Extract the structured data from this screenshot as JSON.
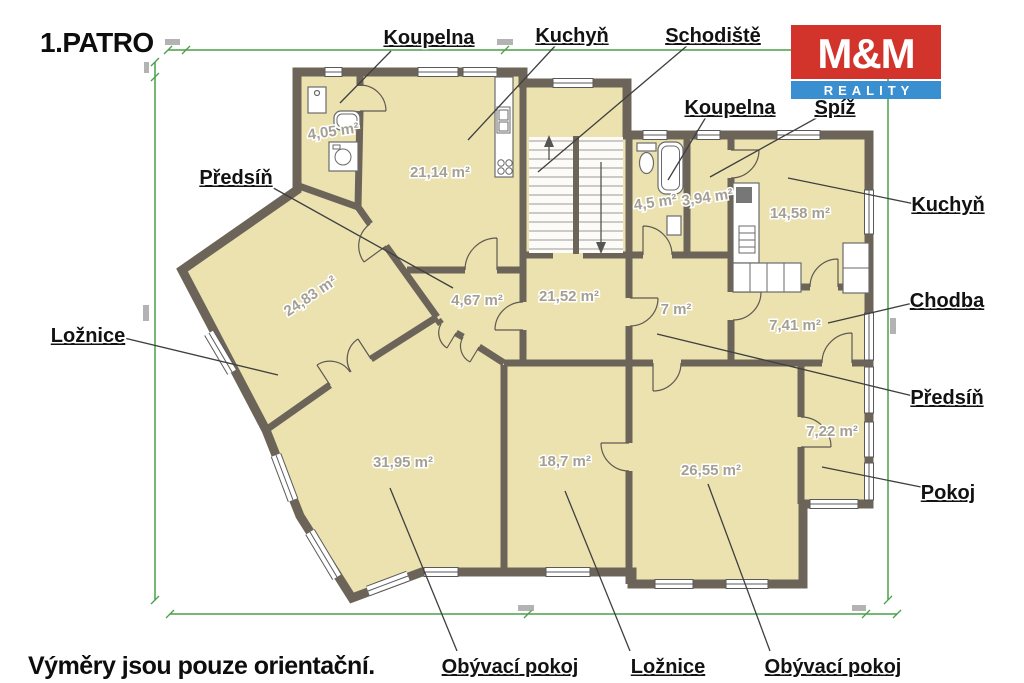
{
  "title": "1.PATRO",
  "disclaimer": "Výměry jsou pouze orientační.",
  "logo": {
    "top": "M&M",
    "bottom": "REALITY",
    "red": "#d2342c",
    "blue": "#3a8fd1"
  },
  "labels": {
    "koupelna_top": "Koupelna",
    "kuchyn_top": "Kuchyň",
    "schodiste": "Schodiště",
    "koupelna_right": "Koupelna",
    "spiz": "Spíž",
    "kuchyn_right": "Kuchyň",
    "chodba": "Chodba",
    "predsin_right": "Předsíň",
    "pokoj": "Pokoj",
    "predsin_left": "Předsíň",
    "loznice_left": "Ložnice",
    "obyvaci_pokoj_left": "Obývací pokoj",
    "loznice_bottom": "Ložnice",
    "obyvaci_pokoj_right": "Obývací pokoj"
  },
  "areas": {
    "koupelna_top": "4,05 m²",
    "kuchyn_top": "21,14 m²",
    "koupelna_right": "4,5 m²",
    "spiz": "3,94 m²",
    "kuchyn_right": "14,58 m²",
    "predsin_left": "4,67 m²",
    "hala": "21,52 m²",
    "predsin_right": "7 m²",
    "chodba": "7,41 m²",
    "loznice_left": "24,83 m²",
    "obyvaci_left": "31,95 m²",
    "loznice_bottom": "18,7 m²",
    "obyvaci_right": "26,55 m²",
    "pokoj": "7,22 m²"
  },
  "colors": {
    "wall": "#6d6459",
    "room_fill": "#ebe2b0",
    "dimension_green": "#4aa04a",
    "area_text": "#a49f93"
  }
}
